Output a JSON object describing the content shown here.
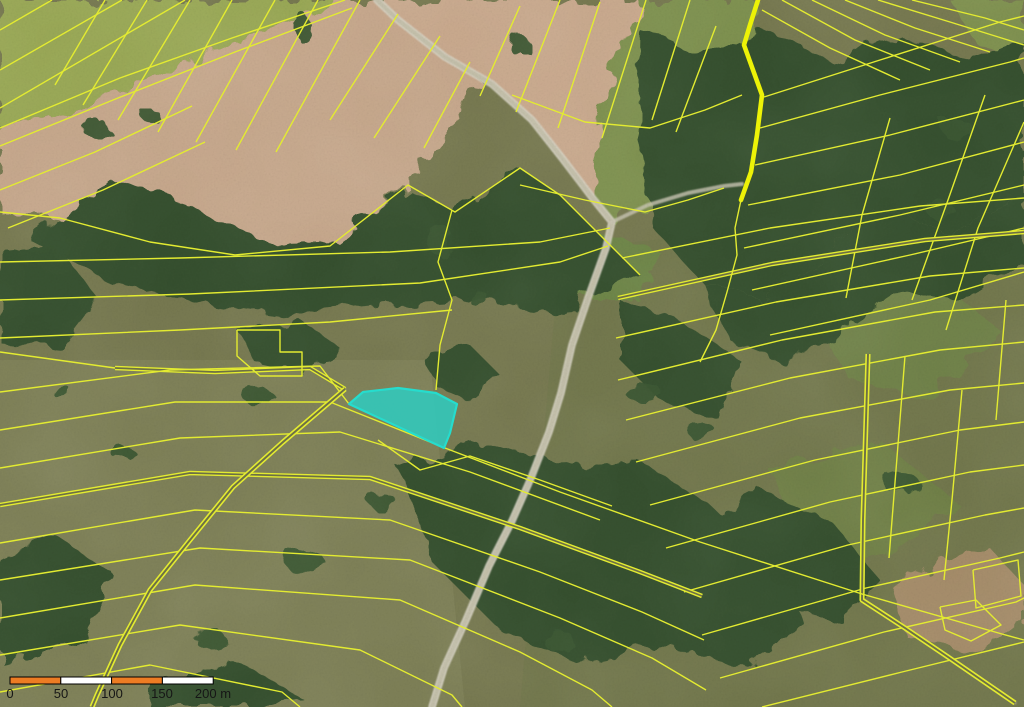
{
  "map": {
    "viewbox": "0 0 1024 707",
    "colors": {
      "base": "#76784f",
      "parcel_line": "#e3eb31",
      "thick_line": "#edf207",
      "double_core": "#6d7045",
      "forest": "#344f2e",
      "clump": "#3a5633",
      "road_casing": "#d8d4c4",
      "road_fill": "#c2bea8",
      "highlight_fill": "#30c9bd",
      "highlight_stroke": "#26dccd",
      "scalebar_orange": "#ed7c23",
      "scalebar_white": "#ffffff",
      "scalebar_border": "#000000",
      "scalebar_label": "#161616"
    },
    "terrain": {
      "shapes": [
        {
          "p": "0,360 430,360 465,707 0,707",
          "f": "#84855c",
          "o": 0.55
        },
        {
          "p": "560,250 1024,200 1024,707 520,707",
          "f": "#6e7549",
          "o": 0.45
        },
        {
          "p": "0,130 118,92 230,42 348,0 377,0 398,20 445,57 480,80 455,125 408,185 330,246 235,255 150,242 60,218 0,212",
          "f": "#c6a78b",
          "r": 1
        },
        {
          "p": "377,0 640,0 615,60 600,120 594,200 562,158 532,120 492,84 445,57 398,20",
          "f": "#c9a98d",
          "r": 1
        },
        {
          "p": "0,0 348,0 230,42 118,92 0,130",
          "f": "#99a855",
          "r": 1
        },
        {
          "p": "640,0 758,0 753,70 762,95 757,135 751,172 741,200 724,186 688,193 648,205 612,222 594,200 600,120 615,60",
          "f": "#7e9150",
          "r": 1
        },
        {
          "p": "950,0 1024,0 1024,62 975,42",
          "f": "#7f9150",
          "r": 1
        },
        {
          "p": "560,230 622,236 660,252 640,300 580,300 545,278",
          "f": "#6d8746",
          "o": 0.9,
          "r": 1
        },
        {
          "p": "800,300 920,268 1000,330 930,400 850,380",
          "f": "#708448",
          "o": 0.85,
          "r": 1
        },
        {
          "p": "770,470 880,440 960,505 880,560 800,545",
          "f": "#6f8346",
          "o": 0.8,
          "r": 1
        },
        {
          "p": "890,585 990,548 1024,585 1024,625 985,655 905,635",
          "f": "#b1906f",
          "o": 0.8,
          "r": 1
        },
        {
          "p": "30,240 110,178 190,205 262,242 335,240 408,188 455,212 520,168 560,195 600,235 640,275 560,310 470,300 380,305 285,315 195,302 110,282",
          "f": "#344f2e",
          "r": 1
        },
        {
          "p": "640,30 700,55 760,28 830,60 900,35 970,60 1024,40 1024,200 950,232 880,210 820,262 760,300 700,280 655,230 638,140",
          "f": "#344f2e",
          "r": 1
        },
        {
          "p": "760,300 820,262 880,210 950,232 1024,200 1024,260 960,300 900,290 840,330 780,360 730,340 700,280",
          "f": "#344f2e",
          "r": 1
        },
        {
          "p": "400,470 480,440 560,465 640,462 710,505 770,560 805,625 745,665 660,645 575,662 495,625 435,565",
          "f": "#344f2e",
          "r": 1
        },
        {
          "p": "0,555 55,535 115,575 85,640 0,662",
          "f": "#344f2e",
          "r": 1
        },
        {
          "p": "150,690 230,658 305,700 260,707 150,707",
          "f": "#344f2e",
          "r": 1
        },
        {
          "p": "0,252 58,246 98,298 60,348 0,342",
          "f": "#344f2e",
          "r": 1
        },
        {
          "p": "420,355 470,345 500,375 470,400 435,385",
          "f": "#344f2e",
          "r": 1
        },
        {
          "p": "240,332 300,320 340,348 300,372 255,362",
          "f": "#344f2e",
          "r": 1
        },
        {
          "p": "620,300 680,320 740,360 720,420 660,400 620,360",
          "f": "#344f2e",
          "r": 1
        },
        {
          "p": "700,520 760,490 830,520 880,580 840,620 770,600 720,565",
          "f": "#344f2e",
          "r": 1
        }
      ],
      "clumps": [
        [
          95,
          128,
          14,
          8
        ],
        [
          152,
          117,
          10,
          6
        ],
        [
          302,
          27,
          9,
          14
        ],
        [
          521,
          47,
          8,
          12
        ],
        [
          258,
          396,
          16,
          8
        ],
        [
          305,
          562,
          20,
          12
        ],
        [
          212,
          641,
          16,
          9
        ],
        [
          643,
          392,
          18,
          10
        ],
        [
          702,
          432,
          14,
          9
        ],
        [
          560,
          642,
          16,
          10
        ],
        [
          383,
          502,
          14,
          8
        ],
        [
          958,
          130,
          16,
          10
        ],
        [
          900,
          482,
          18,
          11
        ],
        [
          122,
          452,
          12,
          7
        ],
        [
          62,
          392,
          10,
          6
        ],
        [
          940,
          210,
          14,
          9
        ],
        [
          440,
          240,
          12,
          16
        ],
        [
          480,
          300,
          10,
          8
        ]
      ]
    },
    "roads": [
      {
        "p": "377,0 398,20 445,57 492,84 532,120 562,158 594,200 612,222 606,248 588,298 572,345 561,393 549,432 531,478 512,521 489,566 466,620 444,668 432,707",
        "c": "#d8d4c4",
        "w": 7.5,
        "o": 0.92
      },
      {
        "p": "377,0 398,20 445,57 492,84 532,120 562,158 594,200 612,222 606,248 588,298 572,345 561,393 549,432 531,478 512,521 489,566 466,620 444,668 432,707",
        "c": "#c2bea8",
        "w": 4.5,
        "o": 0.95
      },
      {
        "p": "612,222 648,205 688,193 724,186 742,184",
        "c": "#c8c4b2",
        "w": 4,
        "o": 0.8
      },
      {
        "p": "345,389 283,442 233,487 190,540 150,590 120,645 97,695 92,707",
        "c": "#a9a77c",
        "w": 3,
        "o": 0.55
      },
      {
        "p": "862,600 905,628 948,657 1015,703",
        "c": "#b9b196",
        "w": 3.5,
        "o": 0.5
      }
    ],
    "lines": [
      {
        "p": "0,30 52,0"
      },
      {
        "p": "0,70 122,0"
      },
      {
        "p": "0,108 185,0"
      },
      {
        "p": "0,128 120,78 232,38 345,0"
      },
      {
        "p": "0,146 118,98 235,52 352,8"
      },
      {
        "p": "0,190 95,152 192,106"
      },
      {
        "p": "8,228 103,190 205,142"
      },
      {
        "p": "0,212 60,218 150,242 235,255 330,246 408,185 455,212 520,168 560,195 600,235 640,275"
      },
      {
        "p": "105,0 55,85"
      },
      {
        "p": "147,0 83,105"
      },
      {
        "p": "190,0 118,120"
      },
      {
        "p": "232,0 158,132"
      },
      {
        "p": "275,0 196,142"
      },
      {
        "p": "318,0 236,150"
      },
      {
        "p": "360,0 276,152"
      },
      {
        "p": "398,14 330,120"
      },
      {
        "p": "440,36 374,138"
      },
      {
        "p": "470,62 424,148"
      },
      {
        "p": "520,6 480,96"
      },
      {
        "p": "560,0 516,112"
      },
      {
        "p": "600,2 558,128"
      },
      {
        "p": "646,0 602,138"
      },
      {
        "p": "690,0 652,120"
      },
      {
        "p": "716,26 676,132"
      },
      {
        "p": "512,95 585,122 650,128 705,110 742,95"
      },
      {
        "p": "520,185 585,200 645,212 688,200 724,188"
      },
      {
        "p": "762,10 830,48 900,80"
      },
      {
        "p": "782,0 855,40 930,70"
      },
      {
        "p": "812,0 885,35 960,62"
      },
      {
        "p": "845,0 915,28 990,52"
      },
      {
        "p": "878,0 950,22 1024,45"
      },
      {
        "p": "912,0 985,18 1024,30"
      },
      {
        "p": "764,97 880,60 1000,22 1024,16"
      },
      {
        "p": "760,128 880,95 1010,62 1024,58"
      },
      {
        "p": "755,165 890,135 1024,100"
      },
      {
        "p": "748,205 900,175 1024,142"
      },
      {
        "p": "744,248 900,215 1024,185"
      },
      {
        "p": "752,290 910,255 1024,228"
      },
      {
        "p": "770,335 930,300 1024,272"
      },
      {
        "p": "985,95 948,200 912,300"
      },
      {
        "p": "890,118 862,215 846,298"
      },
      {
        "p": "1024,122 978,228 946,330"
      },
      {
        "p": "622,258 770,228 920,206 1024,198"
      },
      {
        "p": "618,298 772,264 925,240 1024,232",
        "d": 1
      },
      {
        "p": "616,338 776,302 930,276 1024,268"
      },
      {
        "p": "618,380 782,340 935,312 1024,305"
      },
      {
        "p": "626,420 790,378 940,350 1024,342"
      },
      {
        "p": "636,462 800,418 950,390 1024,383"
      },
      {
        "p": "650,505 815,460 960,430 1024,422"
      },
      {
        "p": "666,548 830,502 970,472 1024,465"
      },
      {
        "p": "684,592 848,545 985,515 1024,508"
      },
      {
        "p": "702,635 866,588 1000,558 1024,552"
      },
      {
        "p": "720,678 884,632 1016,602 1024,598"
      },
      {
        "p": "762,707 902,672 1024,642"
      },
      {
        "p": "868,354 863,520 862,600 905,628 948,657 1015,703",
        "d": 1,
        "w": 1.6
      },
      {
        "p": "905,356 896,470 889,558"
      },
      {
        "p": "962,390 952,500 944,580"
      },
      {
        "p": "1006,300 996,420"
      },
      {
        "p": "973,570 1018,560 1021,596 976,608 973,570"
      },
      {
        "p": "940,607 976,600 1001,625 971,641 945,630 940,607"
      },
      {
        "p": "0,262 180,258 390,252 540,242 610,228"
      },
      {
        "p": "0,300 190,294 420,283 560,262 608,246"
      },
      {
        "p": "0,338 180,330 330,322 452,310"
      },
      {
        "p": "115,368 215,372 310,368 345,389",
        "d": 1
      },
      {
        "p": "0,352 115,368"
      },
      {
        "p": "452,210 438,262 452,300 440,345 436,390"
      },
      {
        "p": "237,330 280,330 280,352 302,352 302,376 260,376 237,356 237,330"
      },
      {
        "p": "0,392 170,370 320,366 349,404"
      },
      {
        "p": "0,430 175,402 330,402 445,448 560,492 700,542 862,594 1002,634 1024,640"
      },
      {
        "p": "0,468 180,438 340,432 470,472 600,520"
      },
      {
        "p": "0,505 190,473 370,478 520,528 640,572 702,596",
        "d": 1
      },
      {
        "p": "0,543 195,510 390,520 540,572 642,612 704,640"
      },
      {
        "p": "0,580 200,548 410,560 560,618 652,658 706,690"
      },
      {
        "p": "0,618 195,585 400,600 520,652 592,690 612,707"
      },
      {
        "p": "0,655 180,625 360,650 452,695 462,707"
      },
      {
        "p": "0,692 150,665 282,692 300,707"
      },
      {
        "p": "345,389 283,442 233,487 190,540 150,590 120,645 97,695 92,707",
        "d": 1,
        "w": 1.6
      },
      {
        "p": "758,0 750,25 744,45 753,70 762,95 757,135 751,172 741,200",
        "w": 4.6,
        "c": "thick"
      },
      {
        "p": "741,200 735,228 737,255 727,292 716,330 700,362"
      },
      {
        "p": "378,440 420,470 470,456 540,480 612,506"
      }
    ],
    "highlight": {
      "p": "349,404 363,392 398,388 436,393 457,404 450,433 444,448",
      "opacity": 0.88
    },
    "scalebar": {
      "x": 10,
      "y": 677,
      "h": 7,
      "seg_w": 50.8,
      "segments": [
        "#ed7c23",
        "#ffffff",
        "#ed7c23",
        "#ffffff"
      ],
      "labels": [
        {
          "t": "0",
          "x": 10
        },
        {
          "t": "50",
          "x": 61
        },
        {
          "t": "100",
          "x": 112
        },
        {
          "t": "150",
          "x": 162
        },
        {
          "t": "200 m",
          "x": 213
        }
      ],
      "font_size": 13
    }
  }
}
